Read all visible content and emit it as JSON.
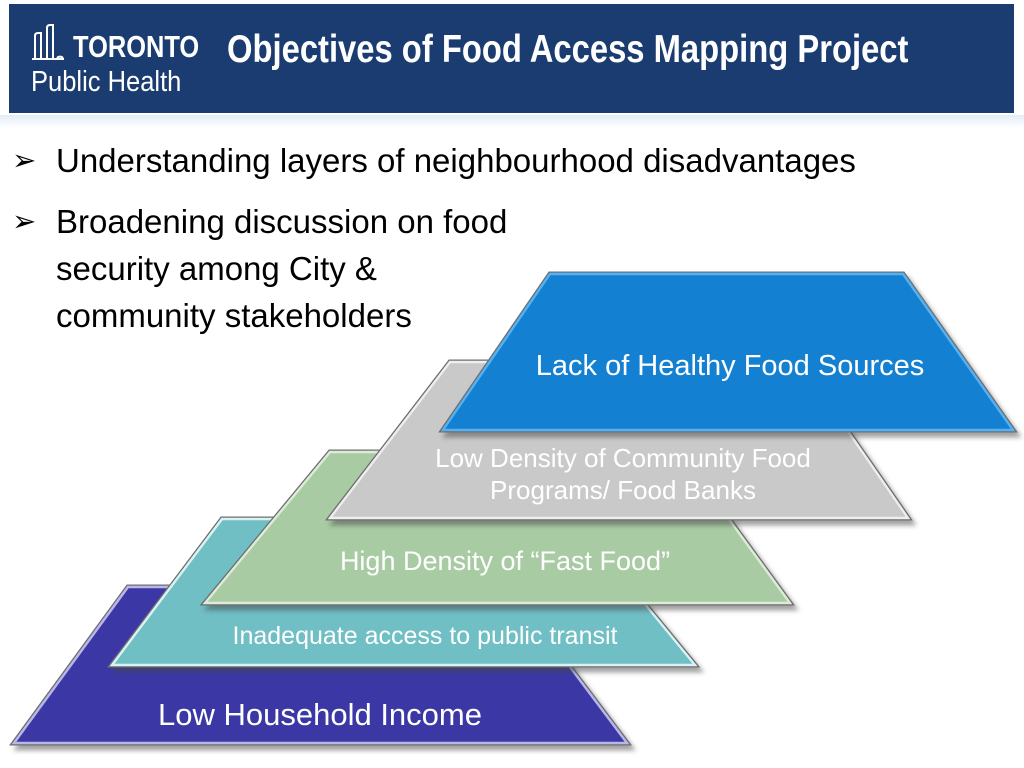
{
  "header": {
    "logo_line1": "TORONTO",
    "logo_line2": "Public Health",
    "title": "Objectives of Food Access Mapping Project"
  },
  "bullets": {
    "marker": "➢",
    "item1": "Understanding layers of neighbourhood disadvantages",
    "item2": "Broadening discussion on food security among City & community stakeholders"
  },
  "diagram": {
    "layers": [
      {
        "label": "Lack of Healthy Food Sources",
        "color": "#1480d2",
        "edge": "#55b1f1"
      },
      {
        "label": "Low Density of Community Food Programs/ Food Banks",
        "color": "#c9c9c9",
        "edge": "#eeeeee"
      },
      {
        "label": "High Density of “Fast Food”",
        "color": "#a9cba4",
        "edge": "#ddecd9"
      },
      {
        "label": "Inadequate access to public transit",
        "color": "#6fbfc5",
        "edge": "#d9f3f5"
      },
      {
        "label": "Low Household Income",
        "color": "#3b38a5",
        "edge": "#b9b7ea"
      }
    ]
  },
  "colors": {
    "header_bg": "#1b3c70",
    "title_text": "#ffffff",
    "body_bg": "#ffffff",
    "bullet_text": "#000000",
    "accent_strip": "#e2ecf6",
    "outline_outer": "#6e6e6e"
  }
}
